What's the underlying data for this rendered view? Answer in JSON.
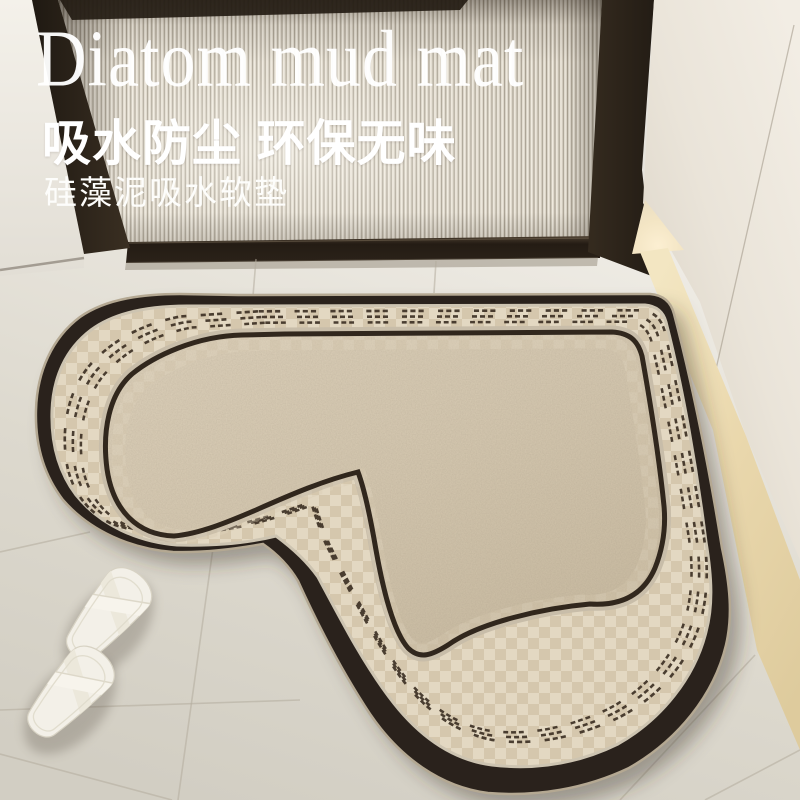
{
  "overlay_text": {
    "title_en": "Diatom mud mat",
    "subtitle_cn": "吸水防尘 环保无味",
    "tagline_cn": "硅藻泥吸水软垫",
    "text_color": "#ffffff"
  },
  "scene": {
    "description": "entryway with fluted glass door, heart-shaped diatom mud mat, white slippers on tile floor",
    "mat": {
      "shape": "heart",
      "border_color": "#2a211a",
      "band_color": "#e1d5bf",
      "field_color": "#d6c9b1",
      "dash_color": "#3a2e22",
      "piping_color": "#cdc4b1"
    },
    "door": {
      "frame_color": "#2b2219",
      "glass_style": "fluted"
    },
    "floor": {
      "tile_color": "#e6e3db",
      "grout_color": "#a9a192",
      "threshold_color": "#eedfb9"
    },
    "slippers": {
      "color": "#f3f0e8",
      "count": 2
    },
    "niche_light_color": "#f9ead0"
  }
}
